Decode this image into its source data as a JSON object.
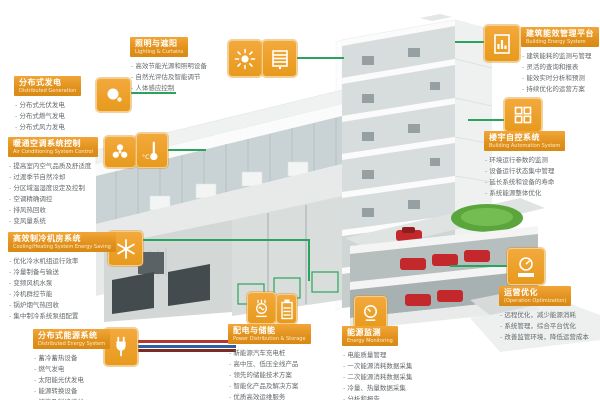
{
  "colors": {
    "accent_orange": "#E2921E",
    "icon_orange": "#EFA12A",
    "connector_green": "#2AA45C",
    "list_text_gray": "#64696C",
    "pipe_red": "#B03A30",
    "pipe_blue": "#2F5FA5",
    "pipe_dark": "#7A2C20",
    "lawn_green": "#5AA63C",
    "car_red": "#C3282C"
  },
  "sections": {
    "distributed_generation": {
      "title": "分布式发电",
      "subtitle": "Distributed Generation",
      "icon": "solar-generation-icon",
      "items": [
        "分布式光伏发电",
        "分布式燃气发电",
        "分布式风力发电"
      ]
    },
    "hvac_control": {
      "title": "暖通空调系统控制",
      "subtitle": "Air Conditioning System Control",
      "icons": [
        "fan-icon",
        "thermometer-icon"
      ],
      "items": [
        "提高室内空气品质及舒适度",
        "过渡季节自然冷却",
        "分区域温湿度设定及控制",
        "空调精确调控",
        "排风热回收",
        "变风量系统"
      ]
    },
    "chiller_plant": {
      "title": "高效制冷机房系统",
      "subtitle": "Cooling/Heating System Energy Saving",
      "icon": "snowflake-icon",
      "items": [
        "优化冷水机组运行效率",
        "冷量制备与输送",
        "变频风机水泵",
        "冷机群控节能",
        "锅炉烟气热回收",
        "集中制冷系统泵组配置"
      ]
    },
    "distributed_energy": {
      "title": "分布式能源系统",
      "subtitle": "Distributed Energy System",
      "icon": "energy-plug-icon",
      "items": [
        "蓄冷蓄热设备",
        "燃气发电",
        "太阳能光伏发电",
        "能源转换设备",
        "储能及削峰填谷"
      ]
    },
    "lighting_shading": {
      "title": "照明与遮阳",
      "subtitle": "Lighting & Curtains",
      "icons": [
        "sun-icon",
        "blinds-icon"
      ],
      "items": [
        "高效节能光源和照明设备",
        "自然光评估及智能调节",
        "人体感应控制"
      ]
    },
    "energy_platform": {
      "title": "建筑能效管理平台",
      "subtitle": "Building Energy System",
      "icon": "report-chart-icon",
      "items": [
        "建筑能耗的监测与管理",
        "灵活的查询和报表",
        "能效实时分析和预测",
        "持续优化的运营方案"
      ]
    },
    "building_automation": {
      "title": "楼宇自控系统",
      "subtitle": "Building Automation System",
      "icon": "window-grid-icon",
      "items": [
        "环境运行参数的监测",
        "设备运行状态集中管理",
        "延长系统和设备的寿命",
        "系统能源整体优化"
      ]
    },
    "operation_optimization": {
      "title": "运营优化",
      "subtitle": "(Operation Optimization)",
      "icon": "gauge-medal-icon",
      "items": [
        "远程优化，减少能源消耗",
        "系统管理，综合平台优化",
        "改善监管环境，降低运营成本"
      ]
    },
    "power_distribution": {
      "title": "配电与储能",
      "subtitle": "Power Distribution & Storage",
      "icons": [
        "transformer-icon",
        "battery-icon"
      ],
      "items": [
        "新能源汽车充电桩",
        "高中压、低压全线产品",
        "领先的储能技术方案",
        "智能化产品及解决方案",
        "优质高效运维服务"
      ]
    },
    "energy_monitoring": {
      "title": "能源监测",
      "subtitle": "Energy Monitoring",
      "icon": "meter-icon",
      "items": [
        "电能质量管理",
        "一次能源消耗数据采集",
        "二次能源消耗数据采集",
        "冷量、热量数据采集",
        "分析和报告"
      ]
    }
  }
}
